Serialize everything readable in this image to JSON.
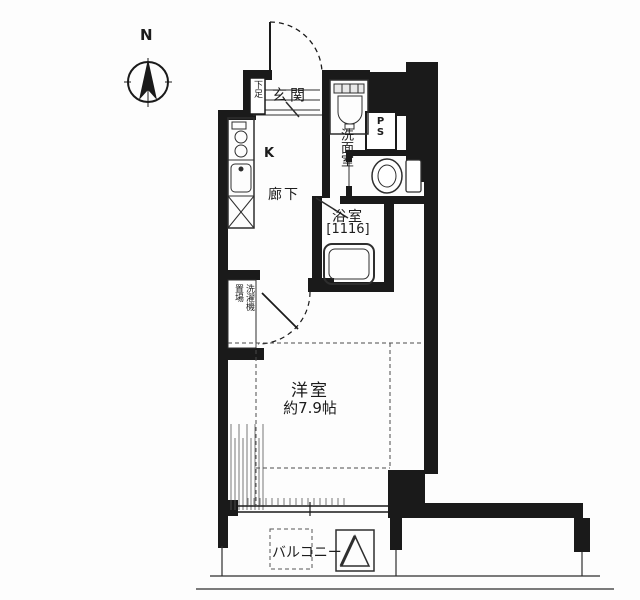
{
  "compass": {
    "north_label": "N"
  },
  "labels": {
    "entrance": "玄関",
    "shoe_box": "下足",
    "kitchen": "K",
    "hallway": "廊下",
    "washroom": "洗面室",
    "pipe_space": "PS",
    "bathroom": "浴室",
    "bathroom_size": "[1116]",
    "washer_space": "洗濯機置場",
    "main_room": "洋室",
    "main_room_size": "約7.9帖",
    "balcony": "バルコニー"
  },
  "colors": {
    "wall": "#1a1a1a",
    "line": "#2e2e2e",
    "background": "#ffffff"
  }
}
